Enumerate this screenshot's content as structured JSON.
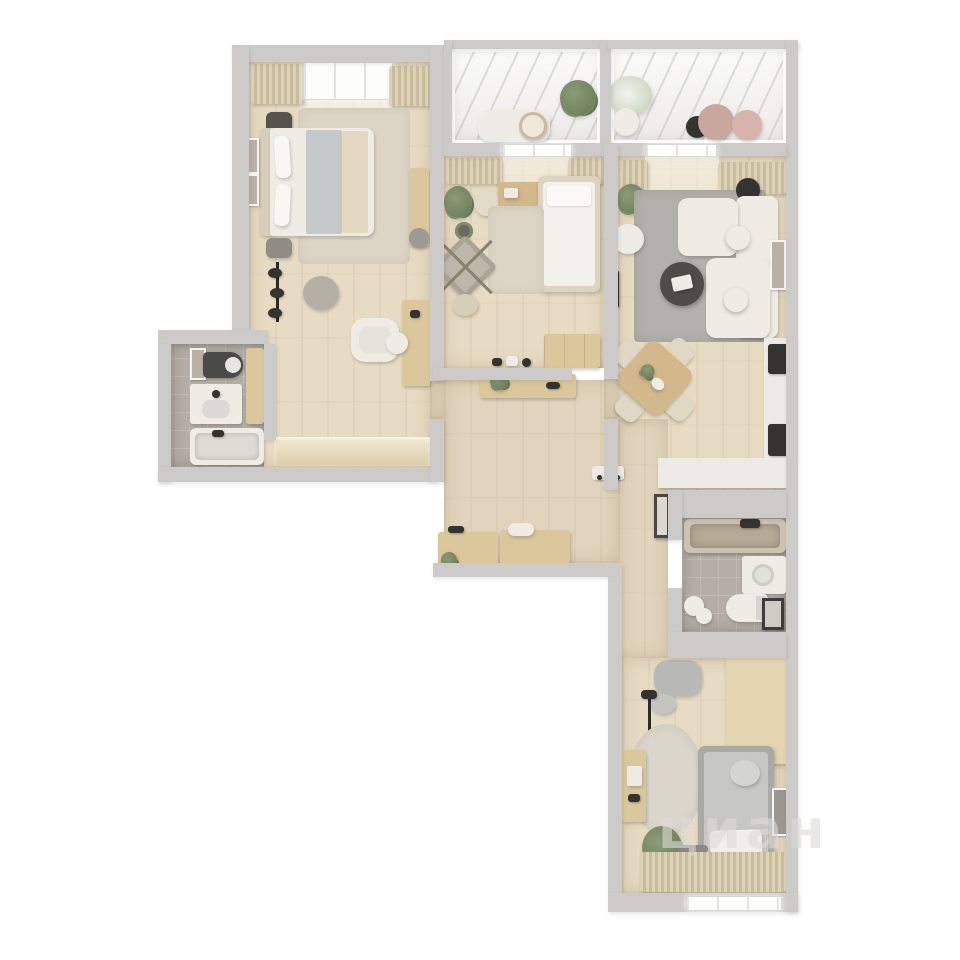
{
  "watermark": {
    "text": "циан"
  },
  "colors": {
    "background": "#ffffff",
    "wall": "#cccbc9",
    "floor_wood": "#e8dbc3",
    "floor_tile": "#b4aea6",
    "furniture_white": "#efece6",
    "furniture_gray": "#c2c2be",
    "furniture_dark": "#35332f",
    "wood_light": "#dcc79c",
    "wood_mid": "#d2b88a",
    "rug_beige": "#dcd5c6",
    "rug_gray": "#b3b1ac",
    "plant_green": "#72825f",
    "kitchen_white": "#edebe7",
    "blush": "#c9a69e",
    "watermark_color": "#dddcda"
  }
}
